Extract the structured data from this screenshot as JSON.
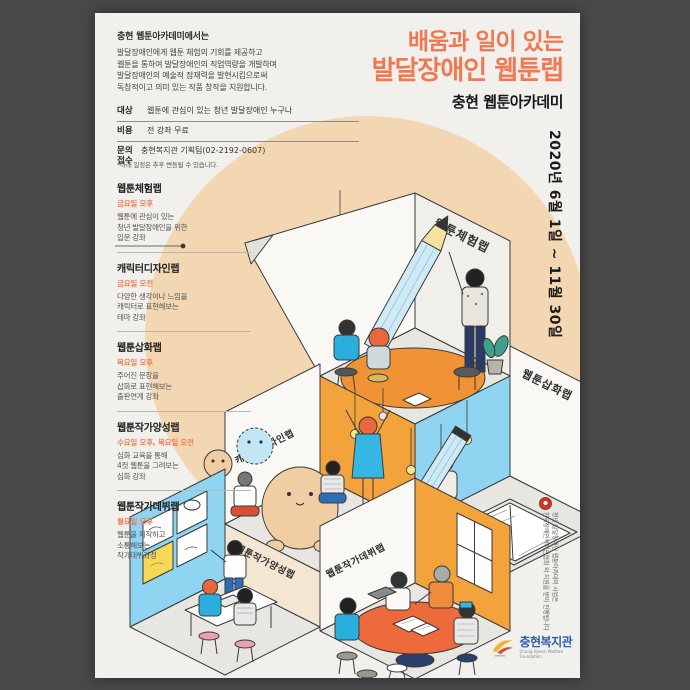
{
  "background": {
    "color": "#494949"
  },
  "poster": {
    "bg_color": "#f2f0ec",
    "intro": {
      "heading": "충현 웹툰아카데미에서는",
      "lines": [
        "발달장애인에게 웹툰 체험의 기회를 제공하고",
        "웹툰을 통하여 발달장애인의 직업역량을 개발하며",
        "발달장애인의 예술적 잠재력을 발현시킴으로써",
        "독창적이고 의미 있는 작품 창작을 지원합니다."
      ],
      "info_rows": [
        {
          "label": "대상",
          "value": "웹툰에 관심이 있는 청년 발달장애인 누구나"
        },
        {
          "label": "비용",
          "value": "전 강좌 무료"
        },
        {
          "label": "문의 접수",
          "value": "충현복지관 기획팀(02-2192-0607)"
        }
      ]
    },
    "title": {
      "line1": "배움과 일이 있는",
      "line2": "발달장애인 웹툰랩",
      "subtitle": "충현 웹툰아카데미",
      "accent_color": "#ee7a53"
    },
    "period_vertical": "2020년 6월 1일 ~ 11월 30일",
    "schedule_note": "*아래 일정은 추후 변동될 수 있습니다.",
    "programs": [
      {
        "name": "웹툰체험랩",
        "time": "금요일 오후",
        "desc": [
          "웹툰에 관심이 있는",
          "청년 발달장애인을 위한",
          "입문 강좌"
        ]
      },
      {
        "name": "캐릭터디자인랩",
        "time": "금요일 오전",
        "desc": [
          "다양한 생각이나 느낌을",
          "캐릭터로 표현해보는",
          "테마 강좌"
        ]
      },
      {
        "name": "웹툰삽화랩",
        "time": "목요일 오후",
        "desc": [
          "주어진 문장을",
          "삽화로 표현해보는",
          "출판연계 강좌"
        ]
      },
      {
        "name": "웹툰작가양성랩",
        "time": "수요일 오후, 목요일 오전",
        "desc": [
          "심화 교육을 통해",
          "4컷 웹툰을 그려보는",
          "심화 강좌"
        ]
      },
      {
        "name": "웹툰작가데뷔랩",
        "time": "월요일 오후",
        "desc": [
          "웹툰을 제작하고",
          "소통해보는",
          "작가데뷔과정"
        ]
      }
    ],
    "rooms": {
      "experience": "웹툰체험랩",
      "character": "캐릭터디자인랩",
      "illustration": "웹툰삽화랩",
      "training": "웹툰작가양성랩",
      "debut": "웹툰작가데뷔랩"
    },
    "footer": {
      "support_line1": "청년 발달장애인 웹툰아카데미 사업은",
      "support_line2": "한국장애인복지관협회 외 지원을 받아 진행됩니다",
      "org_name": "충현복지관",
      "org_name_en": "Chung Hyeon Welfare Foundation"
    },
    "colors": {
      "accent_orange": "#ee7a53",
      "wall_orange": "#f2a33c",
      "wall_blue": "#8fd4f1",
      "rug_orange": "#ef9334",
      "peach_circle": "#f3d7b2",
      "table_orange": "#ed6a3d",
      "logo_blue": "#2e5fae"
    }
  }
}
